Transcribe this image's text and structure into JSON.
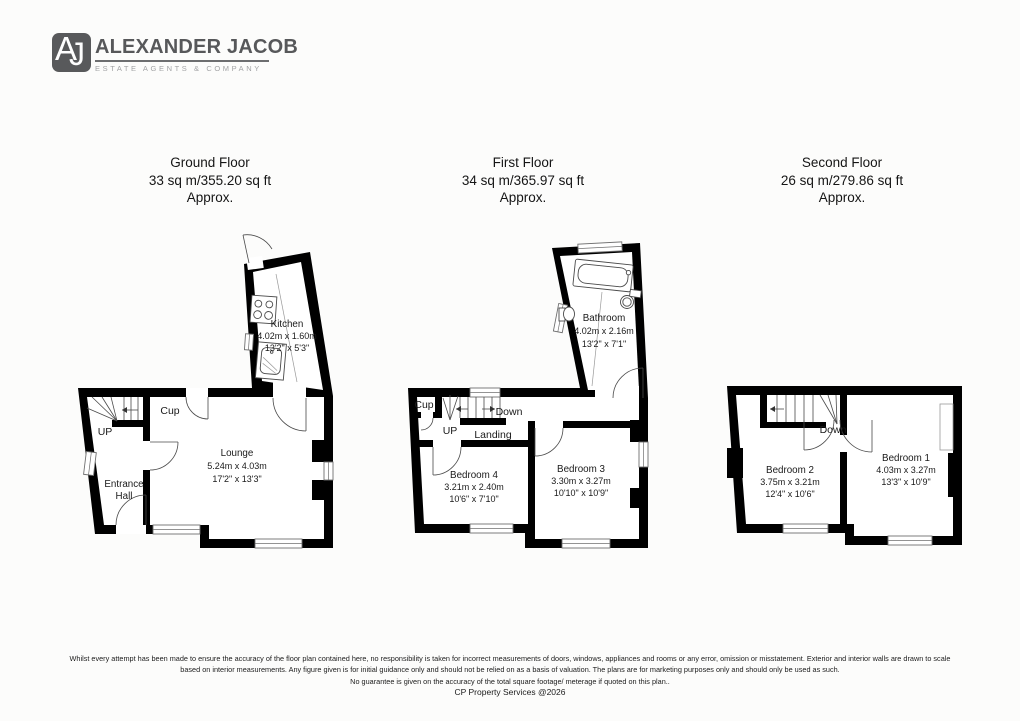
{
  "brand": {
    "monogram_a": "A",
    "monogram_j": "J",
    "name": "ALEXANDER JACOB",
    "tagline": "ESTATE AGENTS & COMPANY",
    "badge_color": "#58595b",
    "name_color": "#57585a",
    "tagline_color": "#a2a3a5"
  },
  "floors": [
    {
      "title": "Ground Floor",
      "area": "33 sq m/355.20 sq ft",
      "approx": "Approx.",
      "rooms": [
        {
          "name": "Kitchen",
          "metric": "4.02m x 1.60m",
          "imperial": "13'2\" x 5'3\""
        },
        {
          "name": "Lounge",
          "metric": "5.24m x 4.03m",
          "imperial": "17'2\" x 13'3\""
        },
        {
          "name_line1": "Entrance",
          "name_line2": "Hall"
        }
      ],
      "labels": {
        "up": "UP",
        "cup": "Cup"
      }
    },
    {
      "title": "First Floor",
      "area": "34 sq m/365.97 sq ft",
      "approx": "Approx.",
      "rooms": [
        {
          "name": "Bathroom",
          "metric": "4.02m x 2.16m",
          "imperial": "13'2\" x 7'1\""
        },
        {
          "name": "Bedroom 4",
          "metric": "3.21m x 2.40m",
          "imperial": "10'6\" x 7'10\""
        },
        {
          "name": "Bedroom 3",
          "metric": "3.30m x 3.27m",
          "imperial": "10'10\" x 10'9\""
        }
      ],
      "labels": {
        "up": "UP",
        "cup": "Cup",
        "down": "Down",
        "landing": "Landing"
      }
    },
    {
      "title": "Second Floor",
      "area": "26 sq m/279.86 sq ft",
      "approx": "Approx.",
      "rooms": [
        {
          "name": "Bedroom 2",
          "metric": "3.75m x 3.21m",
          "imperial": "12'4\" x 10'6\""
        },
        {
          "name": "Bedroom 1",
          "metric": "4.03m x 3.27m",
          "imperial": "13'3\" x 10'9\""
        }
      ],
      "labels": {
        "down": "Down"
      }
    }
  ],
  "footer": {
    "line1": "Whilst every attempt has been made to ensure the accuracy of the floor plan contained here, no responsibility is taken for incorrect measurements of doors, windows, appliances and rooms or any error, omission or misstatement. Exterior and interior walls are drawn to scale",
    "line2": "based on interior measurements. Any figure given is for initial guidance only and should not be relied on as a basis of valuation. The plans are for marketing purposes only and should only be used as such.",
    "line3": "No guarantee is given on the accuracy of the total square footage/ meterage if quoted on this plan..",
    "credit": "CP Property Services @2026"
  },
  "colors": {
    "wall": "#000000",
    "background": "#fcfcfb"
  }
}
